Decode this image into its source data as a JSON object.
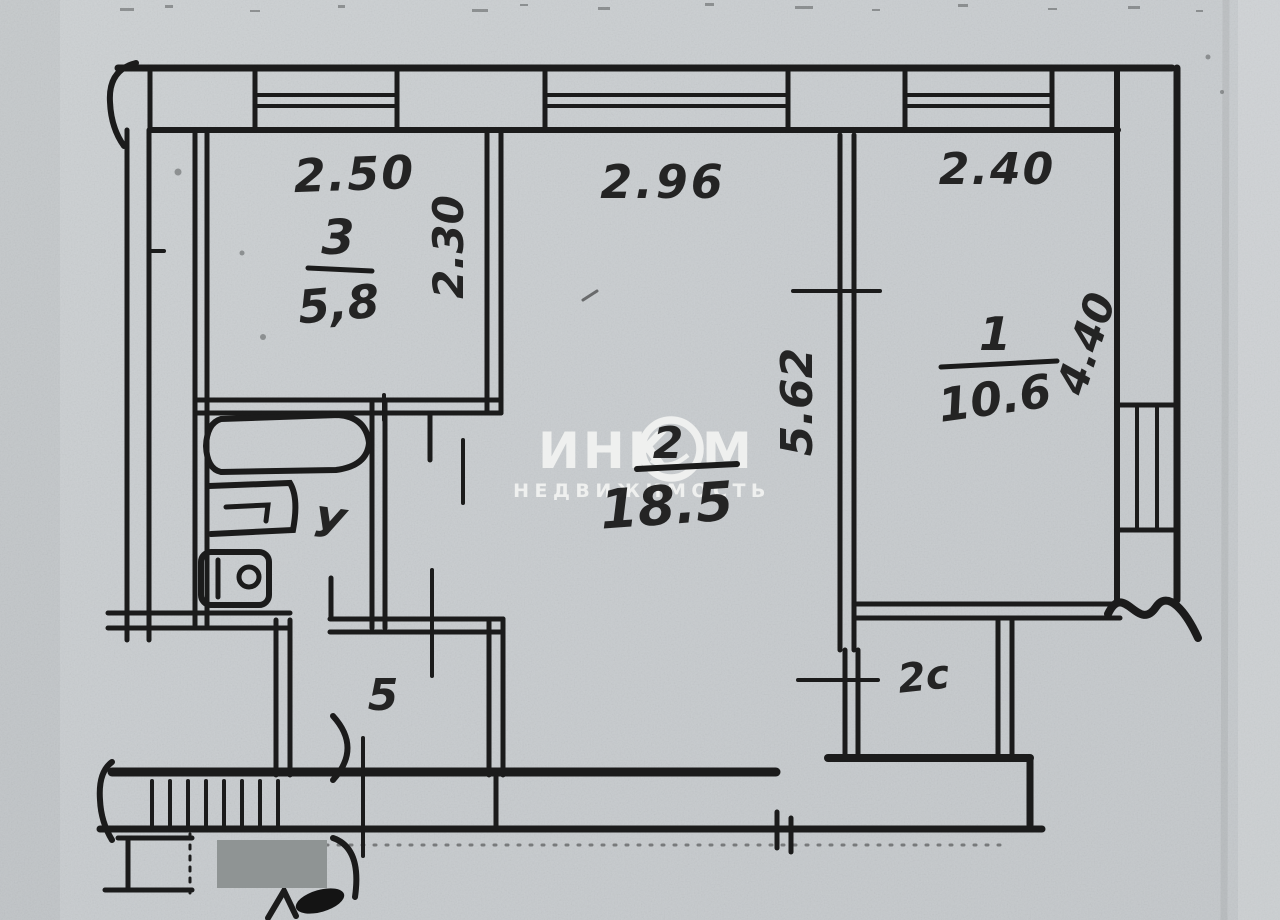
{
  "plan": {
    "dims": {
      "room3_top": "2.50",
      "room3_side": "2.30",
      "room2_top": "2.96",
      "room2_side": "5.62",
      "room1_top": "2.40",
      "room1_side": "4.40"
    },
    "rooms": {
      "room3": {
        "number": "3",
        "area": "5,8"
      },
      "room2": {
        "number": "2",
        "area": "18.5"
      },
      "room1": {
        "number": "1",
        "area": "10.6"
      },
      "hallway": {
        "label": "5"
      },
      "closet": {
        "label": "2с"
      },
      "bathroom": {
        "label": "У"
      }
    },
    "watermark": {
      "brand": "ИНКОМ",
      "brand_left": "ИНК",
      "brand_right": "М",
      "subtitle": "НЕДВИЖИМОСТЬ"
    },
    "colors": {
      "paper": "#c9cdcf",
      "ink": "#1b1b1b",
      "watermark": "#f5f6f4",
      "redaction": "#8f9494"
    }
  }
}
